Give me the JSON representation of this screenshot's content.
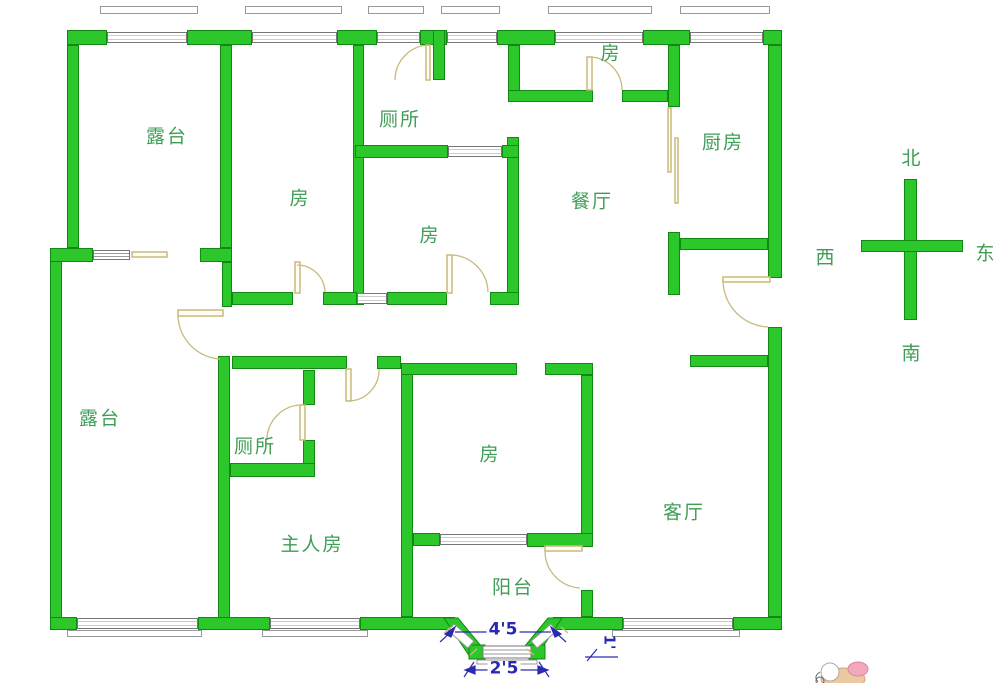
{
  "colors": {
    "wall_green": "#2bc72b",
    "wall_outline": "#118811",
    "door_tan": "#c9ba7c",
    "label_green": "#3f9e55",
    "dimension_blue": "#2a2ab0",
    "window_border": "#777777"
  },
  "rooms": [
    {
      "id": "terrace-upper",
      "label": "露台"
    },
    {
      "id": "room-upper-left",
      "label": "房"
    },
    {
      "id": "toilet-upper",
      "label": "厕所"
    },
    {
      "id": "room-middle",
      "label": "房"
    },
    {
      "id": "room-top-right",
      "label": "房"
    },
    {
      "id": "dining-room",
      "label": "餐厅"
    },
    {
      "id": "kitchen",
      "label": "厨房"
    },
    {
      "id": "terrace-lower",
      "label": "露台"
    },
    {
      "id": "toilet-lower",
      "label": "厕所"
    },
    {
      "id": "master-bedroom",
      "label": "主人房"
    },
    {
      "id": "room-bottom",
      "label": "房"
    },
    {
      "id": "balcony",
      "label": "阳台"
    },
    {
      "id": "living-room",
      "label": "客厅"
    }
  ],
  "compass": {
    "north": "北",
    "south": "南",
    "east": "东",
    "west": "西"
  },
  "dimensions": {
    "bay_width": "4'5",
    "bay_window_width": "2'5",
    "side_depth": "1'"
  }
}
